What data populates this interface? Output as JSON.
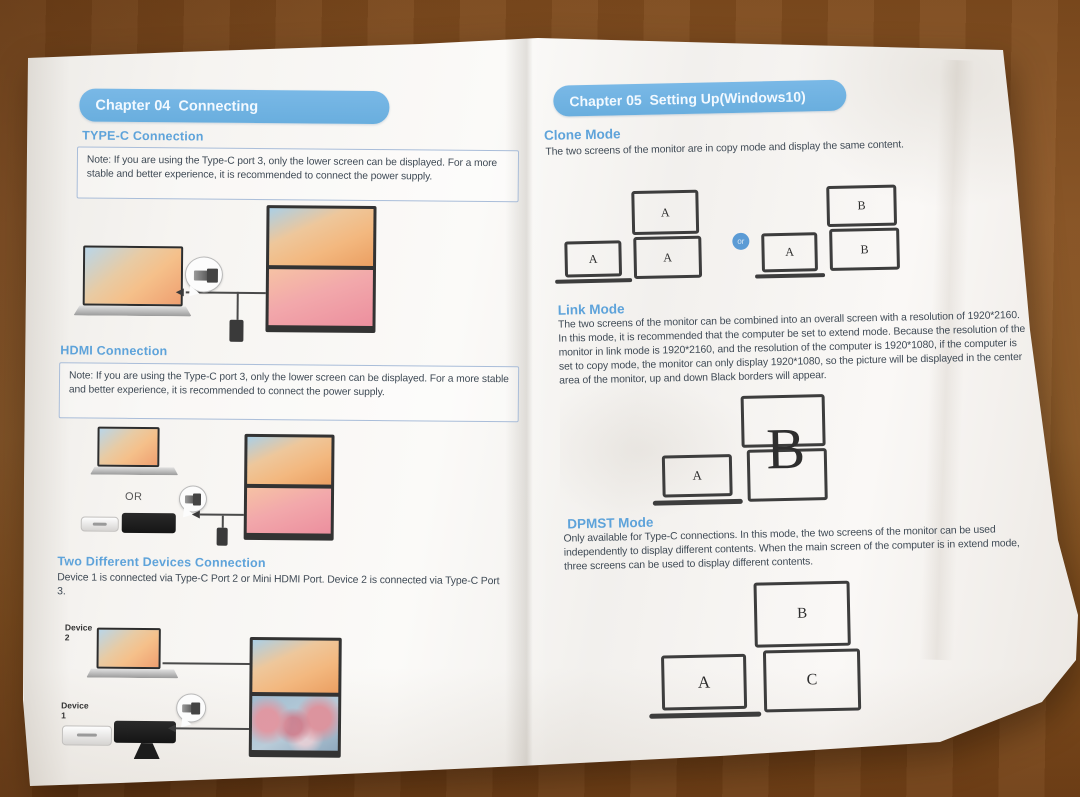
{
  "left_page": {
    "chapter_title": "Chapter 04  Connecting",
    "typec": {
      "title": "TYPE-C Connection",
      "note": "Note: If you are using the Type-C port 3, only the lower screen can be displayed. For a more stable and better experience, it is recommended to connect the power supply."
    },
    "hdmi": {
      "title": "HDMI Connection",
      "note": "Note: If you are using the Type-C port 3, only the lower screen can be displayed. For a more stable and better experience, it is recommended to connect the power supply.",
      "or_label": "OR"
    },
    "two_devices": {
      "title": "Two Different Devices Connection",
      "body": "Device 1 is connected via Type-C Port 2 or Mini HDMI Port. Device 2 is connected via Type-C Port 3.",
      "device2_label": "Device 2",
      "device1_label": "Device 1"
    }
  },
  "right_page": {
    "chapter_title": "Chapter 05  Setting Up(Windows10)",
    "clone": {
      "title": "Clone Mode",
      "body": "The two screens of the monitor are in copy mode and display the same content.",
      "labels": {
        "left_laptop": "A",
        "left_monitor_top": "A",
        "left_monitor_bottom": "A",
        "or": "or",
        "right_laptop": "A",
        "right_monitor_top": "B",
        "right_monitor_bottom": "B"
      }
    },
    "link": {
      "title": "Link Mode",
      "body": "The two screens of the monitor can be combined into an overall screen with a resolution of 1920*2160. In this mode, it is recommended that the computer be set to extend mode. Because the resolution of the monitor in link mode is 1920*2160, and the resolution of the computer is 1920*1080, if the computer is set to copy mode, the monitor can only display 1920*1080, so the picture will be displayed in the center area of the monitor, up and down Black borders will appear.",
      "labels": {
        "laptop": "A",
        "monitor": "B"
      }
    },
    "dpmst": {
      "title": "DPMST Mode",
      "body": "Only available for Type-C connections. In this mode, the two screens of the monitor can be used independently to display different contents. When the main screen of the computer is in extend mode, three screens can be used to display different contents.",
      "labels": {
        "laptop": "A",
        "monitor_top": "B",
        "monitor_bottom": "C"
      }
    }
  },
  "colors": {
    "chapter_header_bg": "#72b3e2",
    "section_heading": "#5ea3da",
    "note_border": "#a9bdd9",
    "body_text": "#3f4a55",
    "or_badge": "#5b9bd5",
    "table_wood": "#8a5526"
  }
}
